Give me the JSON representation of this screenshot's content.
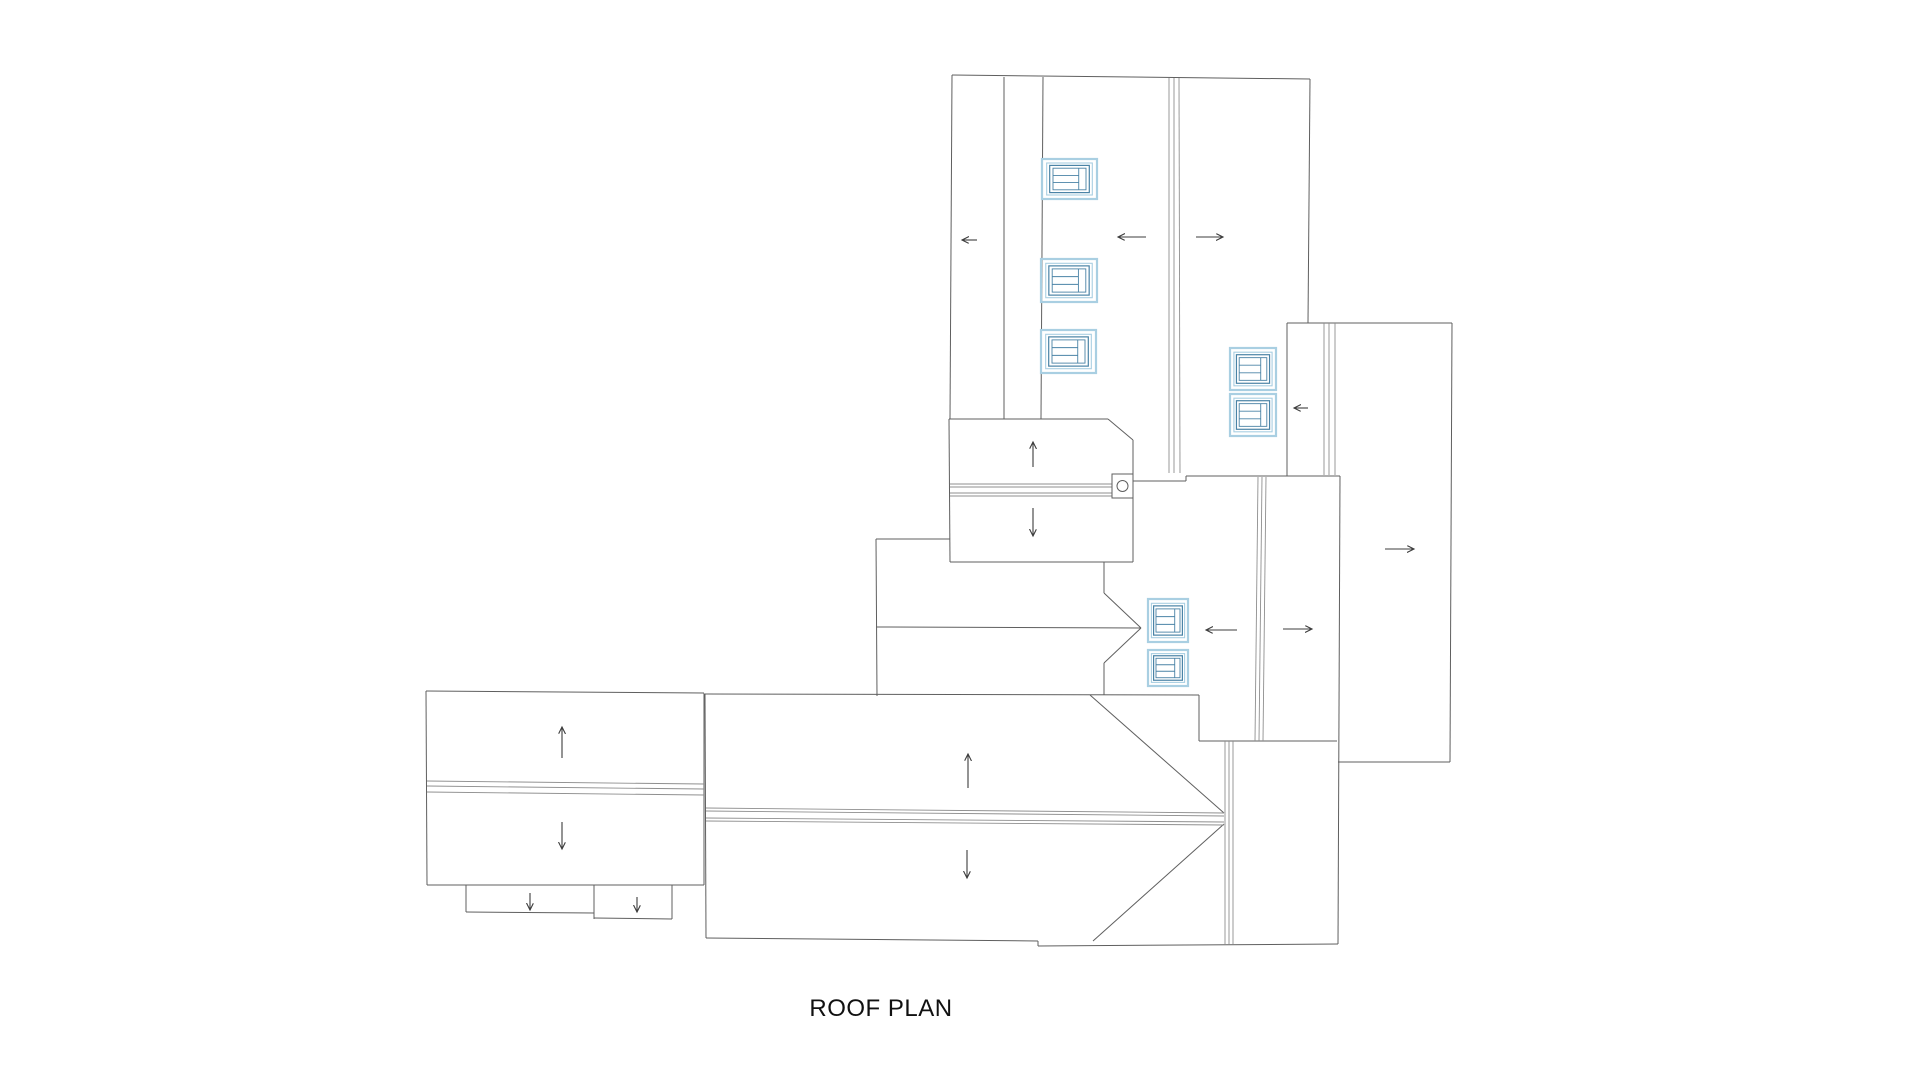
{
  "title": {
    "text": "ROOF PLAN"
  },
  "drawing": {
    "colors": {
      "outline": "#5f5f5f",
      "ridge": "#8f8f8f",
      "arrow": "#3c3c3c",
      "skylight_outer": "#a9cfe2",
      "skylight_inner": "#4a83a6",
      "detail": "#5f5f5f"
    },
    "roof_outlines": [
      [
        952,
        75,
        1310,
        79
      ],
      [
        952,
        75,
        950,
        419
      ],
      [
        1004,
        77,
        1004,
        419
      ],
      [
        1043,
        77,
        1041,
        419
      ],
      [
        1310,
        79,
        1308,
        323
      ],
      [
        949,
        419,
        1108,
        419
      ],
      [
        1108,
        419,
        1133,
        440
      ],
      [
        1133,
        440,
        1133,
        562
      ],
      [
        950,
        562,
        1133,
        562
      ],
      [
        949,
        419,
        950,
        562
      ],
      [
        1133,
        481,
        1186,
        481
      ],
      [
        1186,
        476,
        1186,
        481
      ],
      [
        1186,
        476,
        1340,
        476
      ],
      [
        1287,
        323,
        1452,
        323
      ],
      [
        1287,
        323,
        1287,
        476
      ],
      [
        1452,
        323,
        1450,
        762
      ],
      [
        1338,
        762,
        1450,
        762
      ],
      [
        1340,
        476,
        1338,
        944
      ],
      [
        1199,
        741,
        1337,
        741
      ],
      [
        876,
        539,
        950,
        539
      ],
      [
        876,
        539,
        877,
        696
      ],
      [
        876,
        627,
        1141,
        628
      ],
      [
        1104,
        562,
        1104,
        593
      ],
      [
        1104,
        593,
        1141,
        628
      ],
      [
        1141,
        628,
        1104,
        663
      ],
      [
        1104,
        663,
        1104,
        695
      ],
      [
        426,
        691,
        704,
        693
      ],
      [
        426,
        691,
        427,
        885
      ],
      [
        704,
        693,
        704,
        885
      ],
      [
        427,
        885,
        704,
        885
      ],
      [
        466,
        885,
        466,
        912
      ],
      [
        466,
        912,
        594,
        913
      ],
      [
        594,
        885,
        594,
        919
      ],
      [
        594,
        918,
        672,
        919
      ],
      [
        672,
        885,
        672,
        919
      ],
      [
        705,
        694,
        1199,
        695
      ],
      [
        705,
        694,
        706,
        938
      ],
      [
        706,
        938,
        1038,
        941
      ],
      [
        1038,
        941,
        1038,
        946
      ],
      [
        1038,
        946,
        1338,
        944
      ],
      [
        1090,
        695,
        1224,
        813
      ],
      [
        1093,
        941,
        1224,
        824
      ],
      [
        1199,
        695,
        1199,
        741
      ]
    ],
    "ridge_lines": [
      [
        1169,
        78,
        1169,
        473
      ],
      [
        1174,
        78,
        1174,
        473
      ],
      [
        1179,
        78,
        1180,
        473
      ],
      [
        1324,
        323,
        1324,
        475
      ],
      [
        1329,
        323,
        1329,
        475
      ],
      [
        1335,
        323,
        1335,
        475
      ],
      [
        1258,
        477,
        1255,
        741
      ],
      [
        1262,
        477,
        1259,
        741
      ],
      [
        1266,
        477,
        1263,
        741
      ],
      [
        1225,
        741,
        1225,
        944
      ],
      [
        1229,
        741,
        1229,
        944
      ],
      [
        1233,
        741,
        1233,
        944
      ],
      [
        950,
        484,
        1112,
        484
      ],
      [
        950,
        487,
        1112,
        487
      ],
      [
        950,
        493,
        1112,
        493
      ],
      [
        950,
        496,
        1112,
        496
      ],
      [
        427,
        781,
        704,
        784
      ],
      [
        427,
        786,
        704,
        789
      ],
      [
        427,
        792,
        704,
        795
      ],
      [
        706,
        808,
        1224,
        813
      ],
      [
        706,
        811,
        1224,
        816
      ],
      [
        706,
        818,
        1224,
        822
      ],
      [
        706,
        821,
        1224,
        825
      ]
    ],
    "arrows": [
      {
        "dir": "left",
        "seg": [
          977,
          240,
          962,
          240
        ]
      },
      {
        "dir": "left",
        "seg": [
          1146,
          237,
          1118,
          237
        ]
      },
      {
        "dir": "right",
        "seg": [
          1196,
          237,
          1223,
          237
        ]
      },
      {
        "dir": "left",
        "seg": [
          1308,
          408,
          1294,
          408
        ]
      },
      {
        "dir": "right",
        "seg": [
          1385,
          549,
          1414,
          549
        ]
      },
      {
        "dir": "left",
        "seg": [
          1237,
          630,
          1206,
          630
        ]
      },
      {
        "dir": "right",
        "seg": [
          1283,
          629,
          1312,
          629
        ]
      },
      {
        "dir": "up",
        "seg": [
          1033,
          467,
          1033,
          442
        ]
      },
      {
        "dir": "down",
        "seg": [
          1033,
          508,
          1033,
          536
        ]
      },
      {
        "dir": "up",
        "seg": [
          562,
          758,
          562,
          727
        ]
      },
      {
        "dir": "down",
        "seg": [
          562,
          822,
          562,
          849
        ]
      },
      {
        "dir": "up",
        "seg": [
          968,
          788,
          968,
          754
        ]
      },
      {
        "dir": "down",
        "seg": [
          967,
          850,
          967,
          878
        ]
      },
      {
        "dir": "down",
        "seg": [
          530,
          893,
          530,
          910
        ]
      },
      {
        "dir": "down",
        "seg": [
          637,
          897,
          637,
          912
        ]
      }
    ],
    "skylights": [
      {
        "x": 1042,
        "y": 159,
        "w": 55,
        "h": 40
      },
      {
        "x": 1041,
        "y": 259,
        "w": 56,
        "h": 43
      },
      {
        "x": 1041,
        "y": 330,
        "w": 55,
        "h": 43
      },
      {
        "x": 1230,
        "y": 348,
        "w": 46,
        "h": 42
      },
      {
        "x": 1230,
        "y": 394,
        "w": 46,
        "h": 42
      },
      {
        "x": 1148,
        "y": 599,
        "w": 40,
        "h": 43
      },
      {
        "x": 1148,
        "y": 650,
        "w": 40,
        "h": 36
      }
    ],
    "chimney_detail": {
      "x": 1112,
      "y": 474,
      "w": 21,
      "h": 24,
      "cx": 1122.5,
      "cy": 486,
      "r": 5.5
    }
  }
}
